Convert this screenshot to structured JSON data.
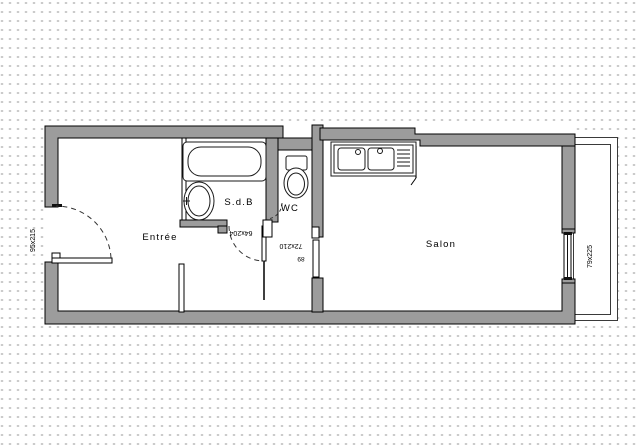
{
  "title": "Studio apartment floor plan",
  "colors": {
    "wall": "#9c9c9c",
    "outline": "#000000",
    "fixture_stroke": "#1a1a1a",
    "background_dot": "#c8c8c8"
  },
  "rooms": [
    {
      "label": "Entrée"
    },
    {
      "label": "S.d.B"
    },
    {
      "label": "WC"
    },
    {
      "label": "Salon"
    }
  ],
  "dimensions": [
    {
      "label": "95x215",
      "location": "entrance-door-left-wall"
    },
    {
      "label": "64x204",
      "location": "bathroom-door"
    },
    {
      "label": "72x210",
      "location": "salon-door"
    },
    {
      "label": "89",
      "location": "passage-width"
    },
    {
      "label": "79x225",
      "location": "salon-window-right-wall"
    }
  ]
}
